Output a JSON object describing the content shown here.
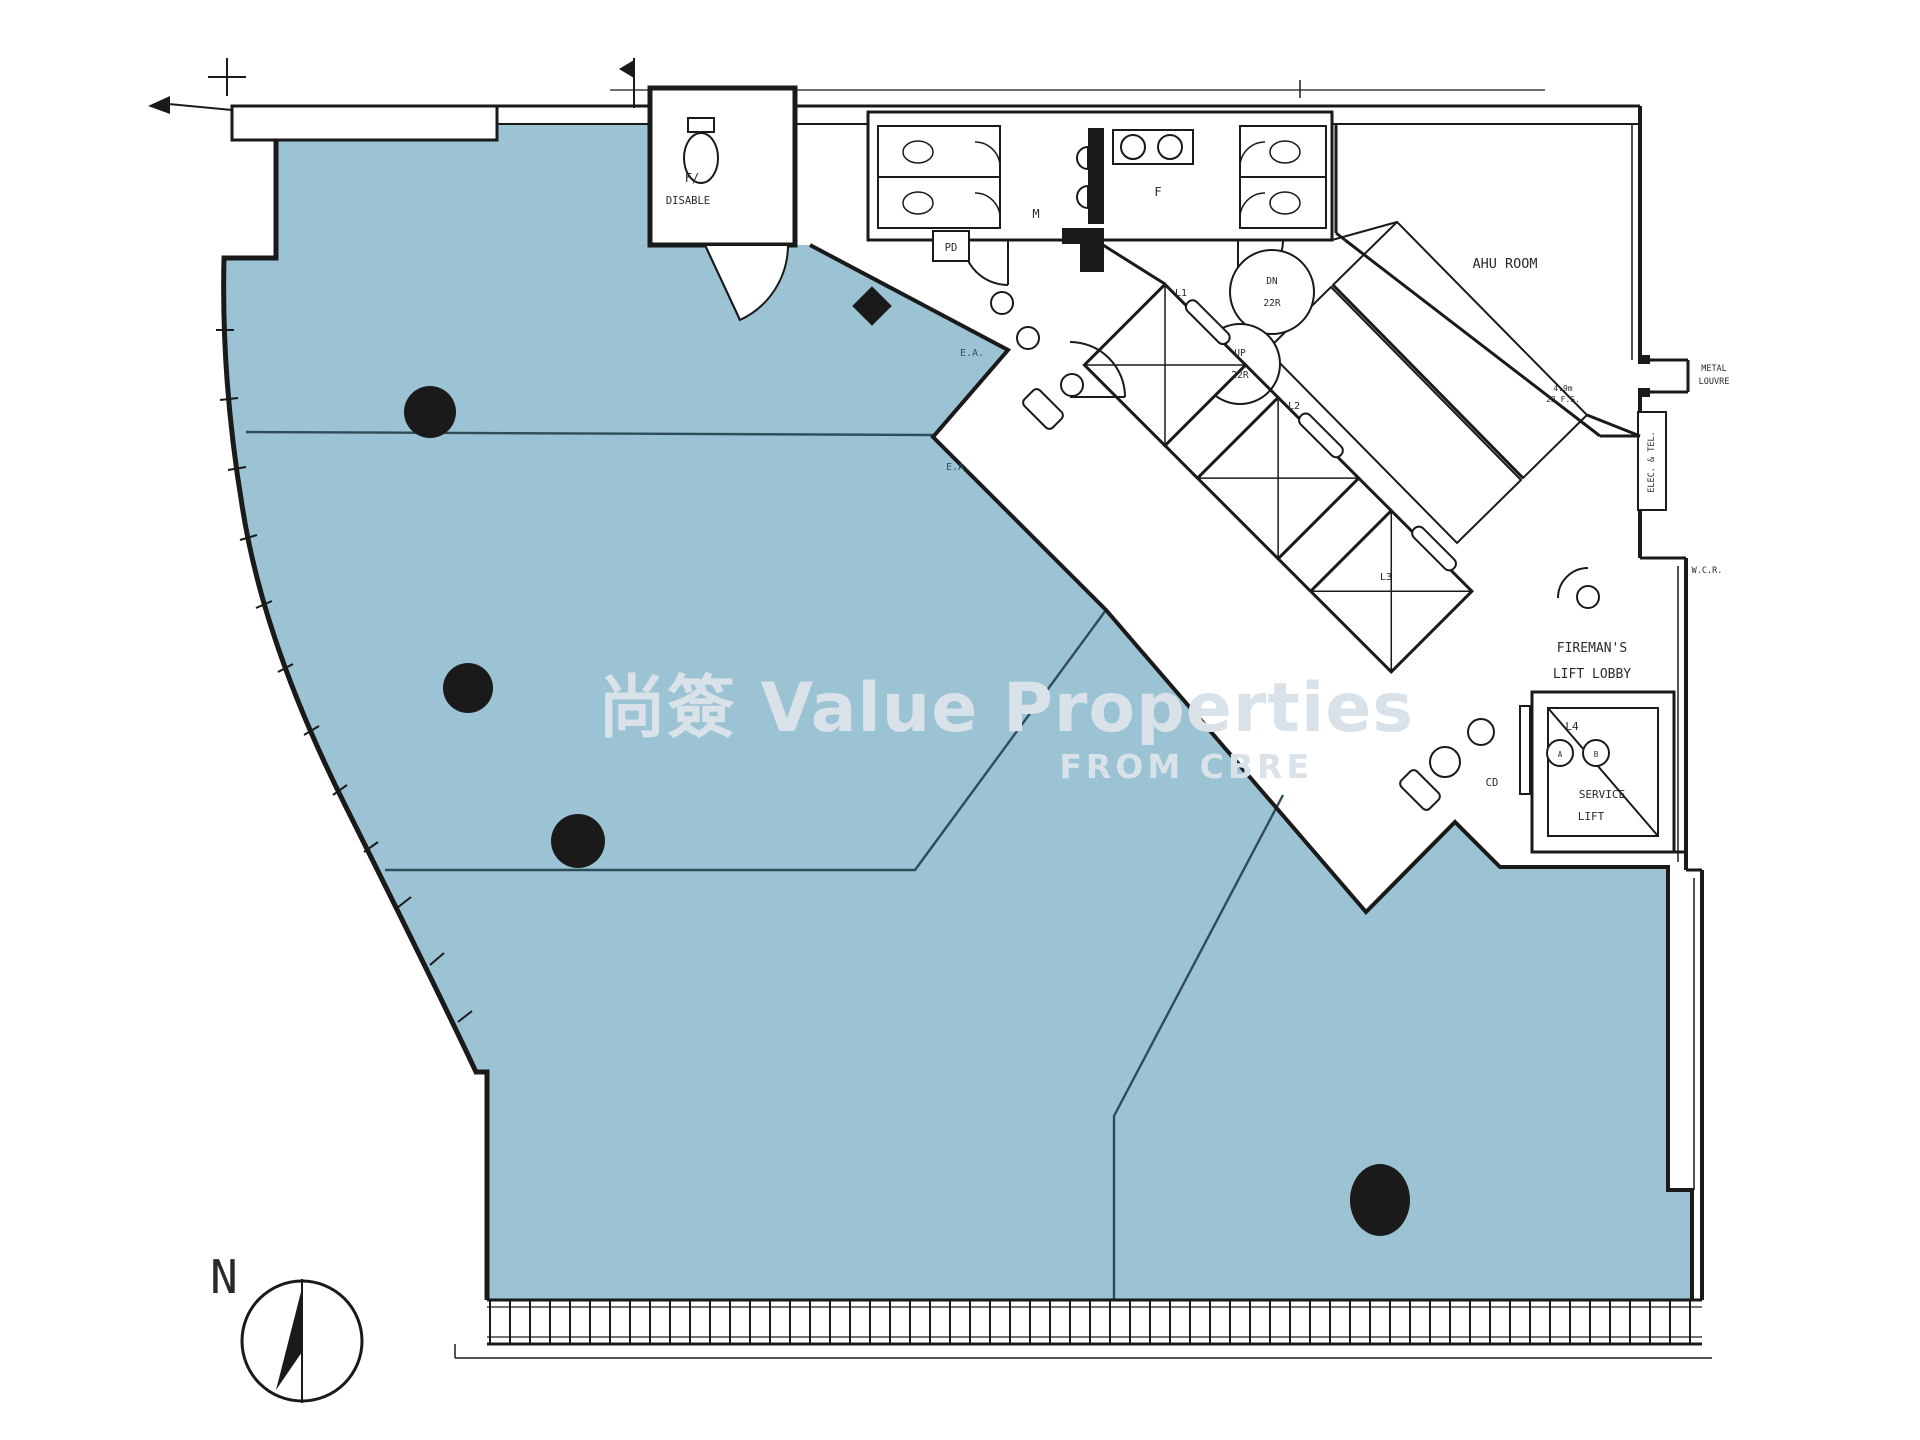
{
  "title": "office floor plan with lettable areas highlighted",
  "watermark": {
    "line1": "尚簽 Value Properties",
    "line2": "FROM CBRE"
  },
  "compass": {
    "north": "N"
  },
  "labels": {
    "toilet1": "F/",
    "toilet2": "DISABLE",
    "pd": "PD",
    "male": "M",
    "female": "F",
    "ahu": "AHU ROOM",
    "dn1": "DN",
    "dn2": "22R",
    "up1": "UP",
    "up2": "22R",
    "l1": "L1",
    "l2": "L2",
    "l3": "L3",
    "l4": "L4",
    "lift_a": "A",
    "lift_b": "B",
    "service1": "SERVICE",
    "service2": "LIFT",
    "fireman1": "FIREMAN'S",
    "fireman2": "LIFT LOBBY",
    "cd": "CD",
    "ea1": "E.A.",
    "ea2": "E.A.",
    "wcr": "W.C.R.",
    "louvre1": "METAL",
    "louvre2": "LOUVRE",
    "elec": "ELEC. & TEL.",
    "dim1": "4.9m",
    "dim2": "23 F.S."
  },
  "colors": {
    "area": "#9bc3d4",
    "tline": "#2f4d59",
    "wall": "#1a1a1a",
    "ink": "#2a2a2a",
    "watermark": "#d9e2e8"
  }
}
